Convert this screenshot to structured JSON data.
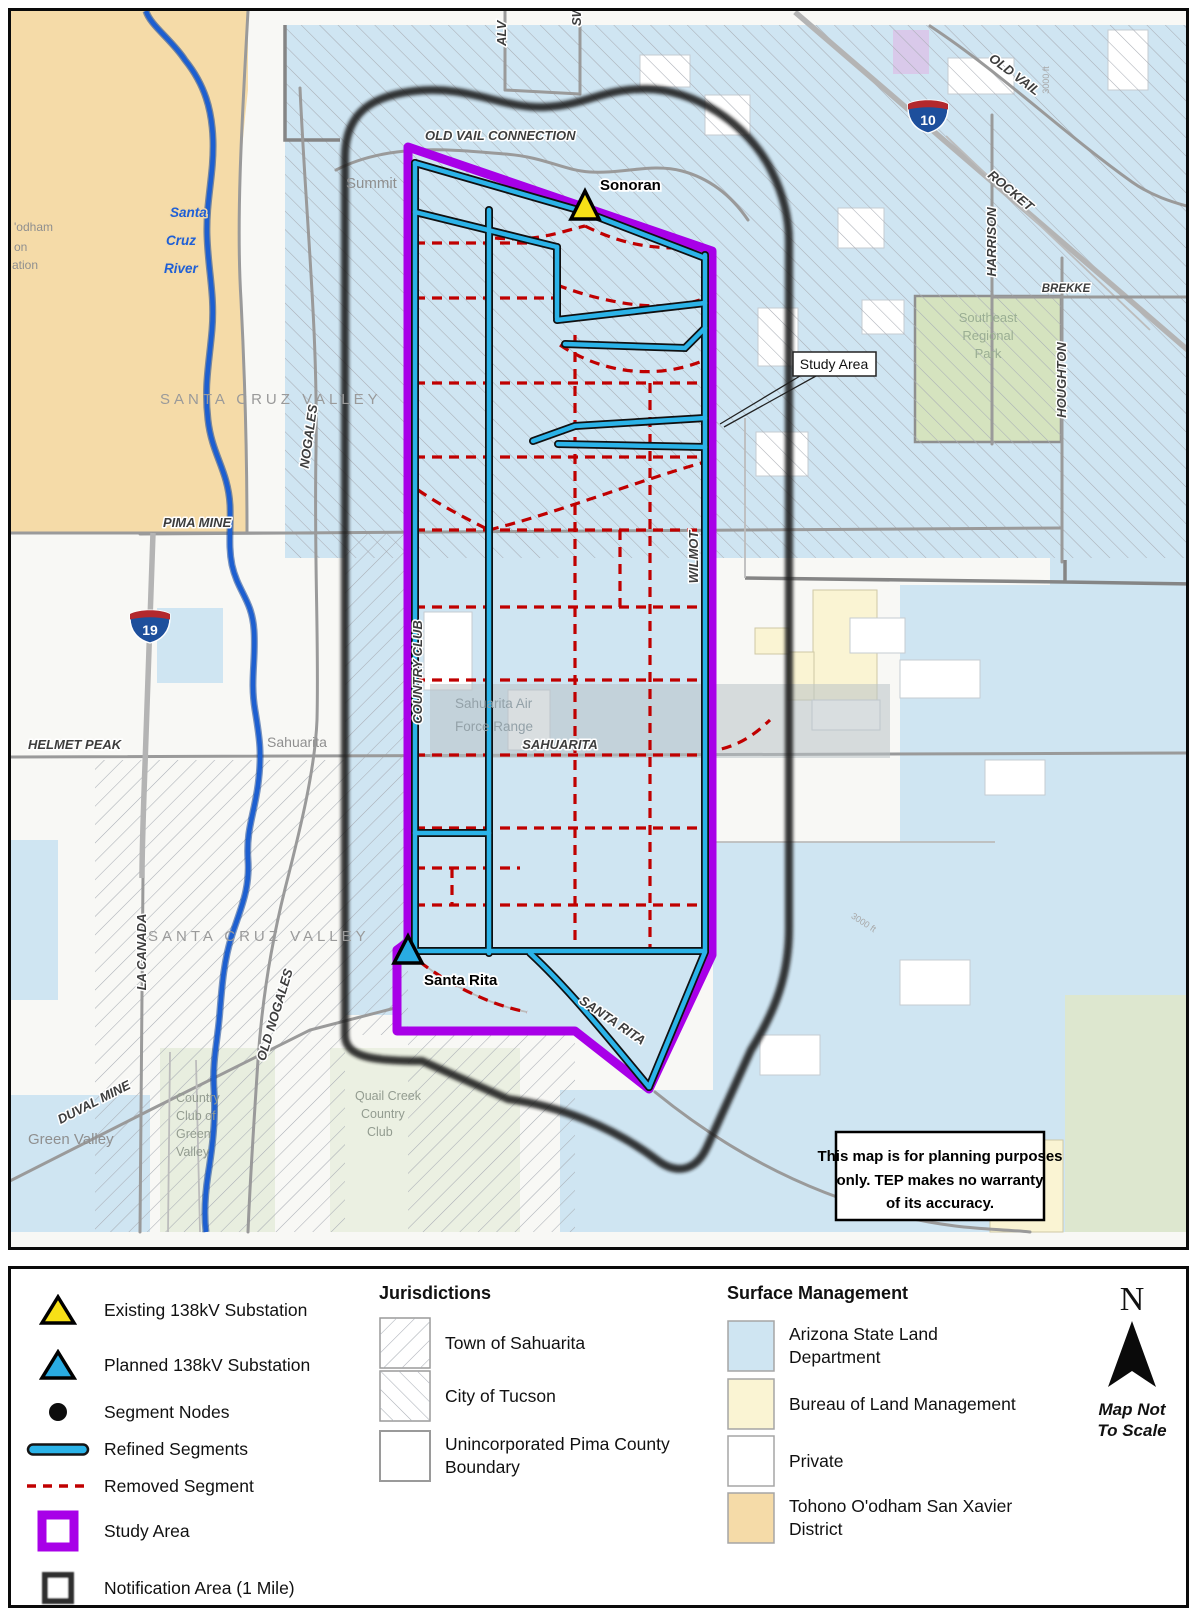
{
  "colors": {
    "study_area": "#A800E8",
    "refined_segment": "#2BB3E8",
    "removed_segment": "#C00000",
    "existing_substation": "#F7E017",
    "planned_substation": "#29ABE2",
    "node": "#0D0D0D",
    "arizona_state_land": "#CFE5F2",
    "blm": "#FAF4D3",
    "private": "#FFFFFF",
    "tohono": "#F5DBA8",
    "park_green": "#D5E3BF"
  },
  "map": {
    "substations": {
      "sonoran": "Sonoran",
      "santa_rita": "Santa Rita"
    },
    "callout": {
      "study_area": "Study Area"
    },
    "roads": {
      "old_vail_connection": "OLD VAIL CONNECTION",
      "old_vail": "OLD VAIL",
      "rocket": "ROCKET",
      "harrison": "HARRISON",
      "houghton": "HOUGHTON",
      "brekke": "BREKKE",
      "alv": "ALV",
      "sw": "SW",
      "nogales": "NOGALES",
      "old_nogales": "OLD NOGALES",
      "la_canada": "LA CANADA",
      "duval_mine": "DUVAL MINE",
      "helmet_peak": "HELMET PEAK",
      "pima_mine": "PIMA MINE",
      "sahuarita": "SAHUARITA",
      "wilmot": "WILMOT",
      "country_club": "COUNTRY CLUB",
      "santa_rita": "SANTA RITA"
    },
    "highways": {
      "i10": "10",
      "i19": "19"
    },
    "places": {
      "summit": "Summit",
      "sahuarita_town": "Sahuarita",
      "green_valley": "Green Valley",
      "santa_cruz_valley": "SANTA CRUZ VALLEY"
    },
    "multiline": {
      "river": [
        "Santa",
        "Cruz",
        "River"
      ],
      "se_park": [
        "Southeast",
        "Regional",
        "Park"
      ],
      "quail_creek": [
        "Quail Creek",
        "Country",
        "Club"
      ],
      "cc_green_valley": [
        "Country",
        "Club of",
        "Green",
        "Valley"
      ],
      "air_force_range": [
        "Sahuarita Air",
        "Force Range"
      ],
      "tohono_partial": [
        "'odham",
        "on",
        "ation"
      ]
    },
    "annotations": {
      "scale_note": "3000 ft"
    },
    "disclaimer": [
      "This map is for planning purposes",
      "only. TEP makes no warranty",
      "of its accuracy."
    ]
  },
  "map_geometry": {
    "segment_nodes": [
      [
        415,
        163
      ],
      [
        415,
        205
      ],
      [
        415,
        222
      ],
      [
        415,
        242
      ],
      [
        415,
        298
      ],
      [
        415,
        383
      ],
      [
        415,
        457
      ],
      [
        415,
        493
      ],
      [
        415,
        530
      ],
      [
        415,
        607
      ],
      [
        415,
        680
      ],
      [
        415,
        755
      ],
      [
        415,
        833
      ],
      [
        415,
        868
      ],
      [
        415,
        905
      ],
      [
        415,
        930
      ],
      [
        415,
        950
      ],
      [
        489,
        212
      ],
      [
        489,
        310
      ],
      [
        489,
        342
      ],
      [
        489,
        383
      ],
      [
        489,
        457
      ],
      [
        489,
        530
      ],
      [
        489,
        607
      ],
      [
        489,
        680
      ],
      [
        489,
        755
      ],
      [
        489,
        833
      ],
      [
        489,
        880
      ],
      [
        489,
        905
      ],
      [
        489,
        950
      ],
      [
        705,
        258
      ],
      [
        705,
        298
      ],
      [
        705,
        325
      ],
      [
        705,
        383
      ],
      [
        705,
        418
      ],
      [
        705,
        447
      ],
      [
        705,
        530
      ],
      [
        705,
        607
      ],
      [
        705,
        680
      ],
      [
        705,
        717
      ],
      [
        705,
        755
      ],
      [
        705,
        833
      ],
      [
        705,
        905
      ],
      [
        705,
        950
      ],
      [
        500,
        190
      ],
      [
        512,
        218
      ],
      [
        545,
        205
      ],
      [
        575,
        213
      ],
      [
        582,
        222
      ],
      [
        650,
        240
      ],
      [
        462,
        177
      ],
      [
        577,
        426
      ],
      [
        647,
        424
      ],
      [
        670,
        427
      ],
      [
        533,
        441
      ],
      [
        558,
        444
      ],
      [
        520,
        953
      ],
      [
        530,
        951
      ],
      [
        577,
        951
      ],
      [
        655,
        951
      ],
      [
        649,
        1087
      ]
    ]
  },
  "legend": {
    "symbols": [
      {
        "label": "Existing 138kV Substation"
      },
      {
        "label": "Planned 138kV Substation"
      },
      {
        "label": "Segment Nodes"
      },
      {
        "label": "Refined Segments"
      },
      {
        "label": "Removed Segment"
      },
      {
        "label": "Study Area"
      },
      {
        "label": "Notification Area (1 Mile)"
      }
    ],
    "jurisdictions": {
      "title": "Jurisdictions",
      "items": [
        [
          "Town of Sahuarita"
        ],
        [
          "City of Tucson"
        ],
        [
          "Unincorporated Pima County",
          "Boundary"
        ]
      ]
    },
    "surface": {
      "title": "Surface Management",
      "items": [
        [
          "Arizona State Land",
          "Department"
        ],
        [
          "Bureau of Land Management"
        ],
        [
          "Private"
        ],
        [
          "Tohono O'odham San Xavier",
          "District"
        ]
      ]
    },
    "north": {
      "letter": "N",
      "note": [
        "Map Not",
        "To Scale"
      ]
    }
  }
}
